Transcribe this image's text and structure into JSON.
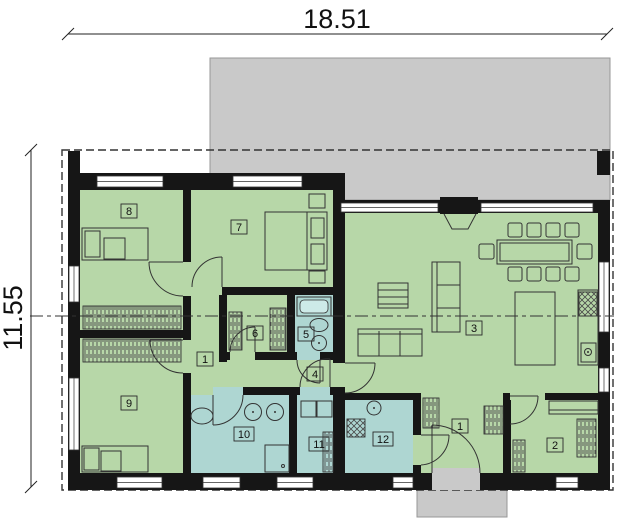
{
  "dimensions": {
    "width": "18.51",
    "height": "11.55"
  },
  "rooms": [
    {
      "id": "hallway",
      "number": "1"
    },
    {
      "id": "entry-hall",
      "number": "1"
    },
    {
      "id": "wardrobe-room",
      "number": "2"
    },
    {
      "id": "living-kitchen",
      "number": "3"
    },
    {
      "id": "inner-corridor",
      "number": "4"
    },
    {
      "id": "bathroom-small",
      "number": "5"
    },
    {
      "id": "closet",
      "number": "6"
    },
    {
      "id": "bedroom-7",
      "number": "7"
    },
    {
      "id": "bedroom-8",
      "number": "8"
    },
    {
      "id": "bedroom-9",
      "number": "9"
    },
    {
      "id": "bathroom-main",
      "number": "10"
    },
    {
      "id": "utility-11",
      "number": "11"
    },
    {
      "id": "laundry-12",
      "number": "12"
    }
  ],
  "colors": {
    "room_green": "#b7d7a8",
    "room_wet": "#aed6d2",
    "terrace": "#c9c9c9",
    "terrace_border": "#979797",
    "wall": "#161616",
    "fixture_fill": "#cdeae8"
  }
}
